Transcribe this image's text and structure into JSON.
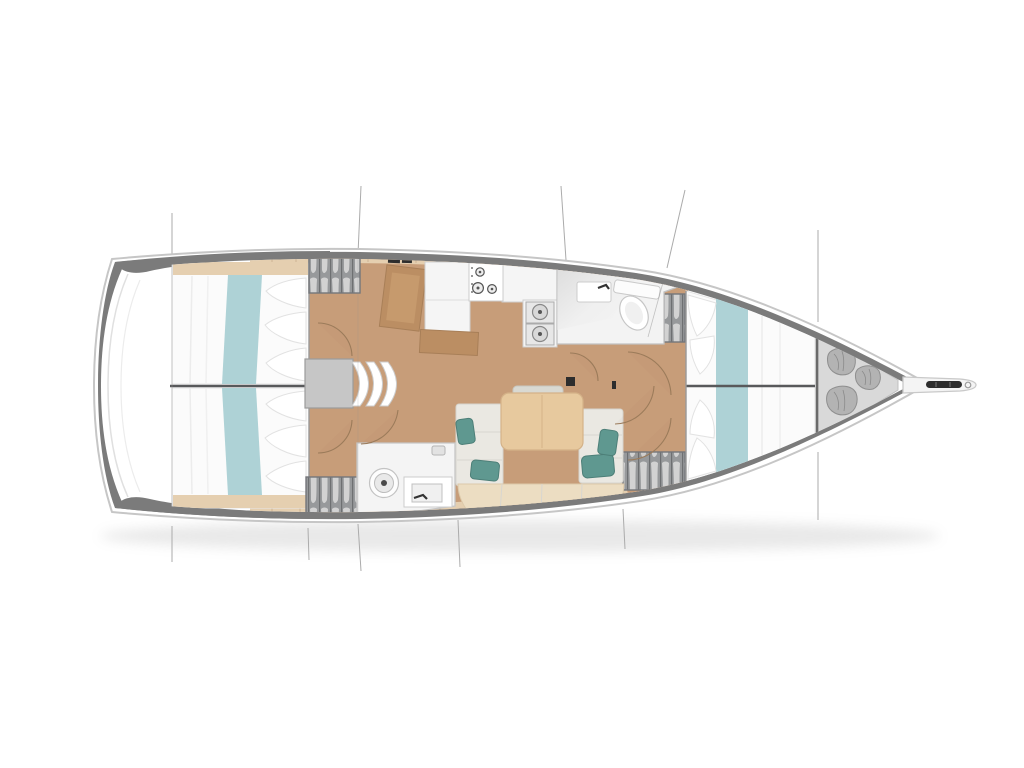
{
  "canvas": {
    "width": 1024,
    "height": 768,
    "background": "#ffffff"
  },
  "colors": {
    "hull_band": "#7b7b7b",
    "hull_outline": "#c6c6c6",
    "deck_white": "#ffffff",
    "floor_wood": "#c79d79",
    "trim_wood": "#e5cfb0",
    "furniture_wood": "#bb8e63",
    "table_wood": "#e7c99e",
    "bed_linen": "#fbfbfb",
    "bed_runner_teal": "#aed2d6",
    "pillow_teal": "#5f9890",
    "sofa_cushion": "#eae8e2",
    "bench_cushion": "#ecddc2",
    "wardrobe_gray": "#97999b",
    "fixture_white": "#f5f5f5",
    "locker_floor": "#d9d9d9",
    "sail_bag": "#b3b3b3",
    "divider_dark": "#58595b",
    "section_line": "#ababab",
    "door_arc": "#9b7b5a",
    "hardware_dark": "#2d2d2d"
  },
  "regions": [
    "swim-platform",
    "aft-cabin-port",
    "aft-cabin-starboard",
    "companionway-steps",
    "nav-station",
    "galley",
    "forward-head",
    "aft-head",
    "salon",
    "salon-table",
    "salon-sofa",
    "wardrobes",
    "forward-cabin",
    "sail-locker",
    "bowsprit",
    "section-lines"
  ]
}
